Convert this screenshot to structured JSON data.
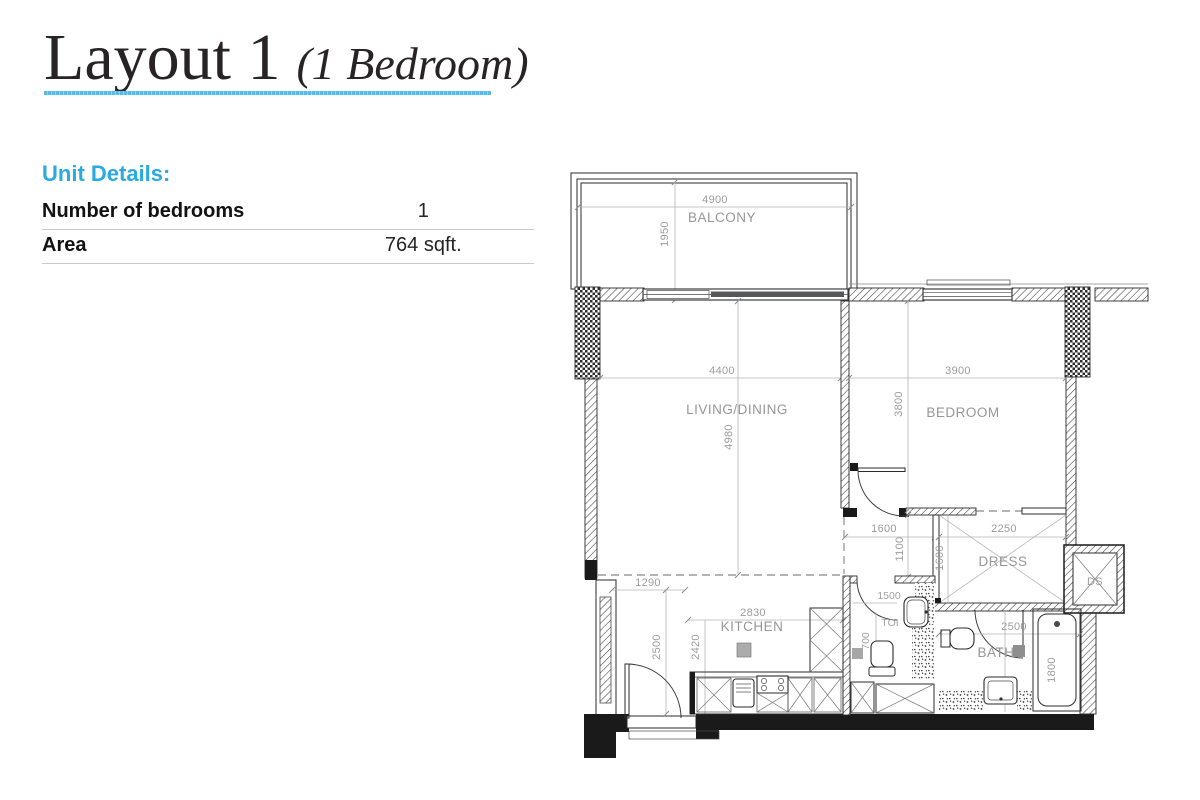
{
  "title": {
    "main": "Layout 1",
    "sub": "(1 Bedroom)"
  },
  "unit_details": {
    "heading": "Unit Details:",
    "rows": [
      {
        "label": "Number of bedrooms",
        "value": "1"
      },
      {
        "label": "Area",
        "value": "764 sqft."
      }
    ]
  },
  "floorplan": {
    "balcony": {
      "label": "BALCONY",
      "width": "4900",
      "depth": "1950"
    },
    "living": {
      "label": "LIVING/DINING",
      "width": "4400",
      "depth": "4980"
    },
    "bedroom": {
      "label": "BEDROOM",
      "width": "3900",
      "depth": "3800"
    },
    "hall": {
      "width": "1600",
      "depth": "1100"
    },
    "dress": {
      "label": "DRESS",
      "width": "2250",
      "depth": "1600"
    },
    "duct_shaft": {
      "label": "DS"
    },
    "kitchen": {
      "label": "KITCHEN",
      "width": "2830",
      "depth": "2420",
      "entry_width": "1290",
      "entry_depth": "2500"
    },
    "toilet": {
      "label": "TOI",
      "width": "1500",
      "depth": "700"
    },
    "bath": {
      "label": "BATH",
      "width": "2500",
      "tub_length": "1800"
    }
  },
  "colors": {
    "accent_blue": "#29abe2",
    "underline_blue": "#58bae9",
    "wall_dark": "#1a1a1a",
    "dim_gray": "#9c9c9c"
  }
}
